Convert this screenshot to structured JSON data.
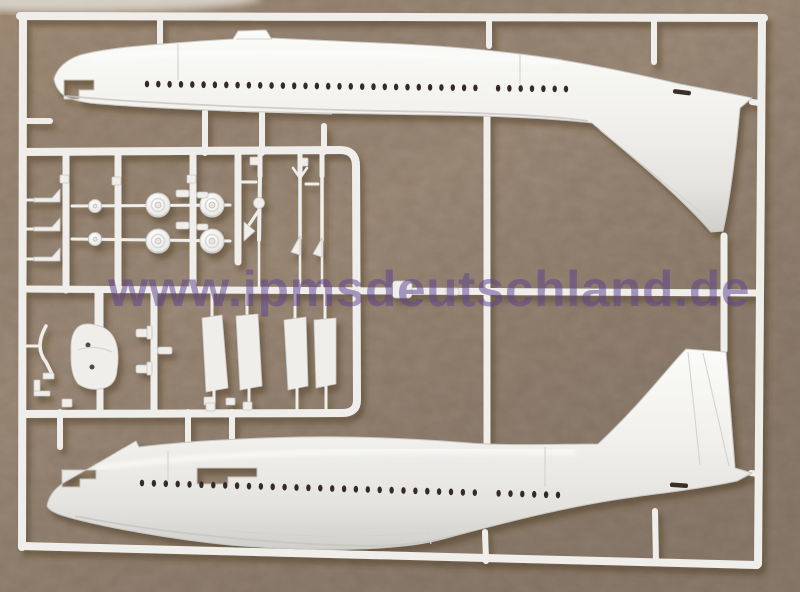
{
  "scene": {
    "description": "Injection-moulded white polystyrene model-kit sprue with two airliner fuselage halves and small detail parts, photographed on a brown fibreboard backing",
    "watermark": {
      "text": "www.ipmsdeutschland.de",
      "color": "#5d4390",
      "opacity": 0.52
    },
    "colors": {
      "board": "#93806e",
      "board_light": "#a88f72",
      "board_dark": "#7f746c",
      "plastic": "#efeeea",
      "plastic_bright": "#fbfbf9",
      "plastic_shadow": "#d3d2ce",
      "window": "#352a26",
      "cast_shadow": "#46331f"
    },
    "parts": {
      "fuselage_top": {
        "label": "left fuselage half with tail-fin fillet",
        "window_count": 38
      },
      "fuselage_bottom": {
        "label": "right fuselage half with vertical tail fin",
        "window_count": 36
      },
      "small_parts": {
        "main_wheels": 4,
        "nose_wheels": 2,
        "landing_gear_struts": 3,
        "gear_door_panels": 4,
        "antenna_horns": 3,
        "gear_bay_box": 1
      }
    }
  }
}
